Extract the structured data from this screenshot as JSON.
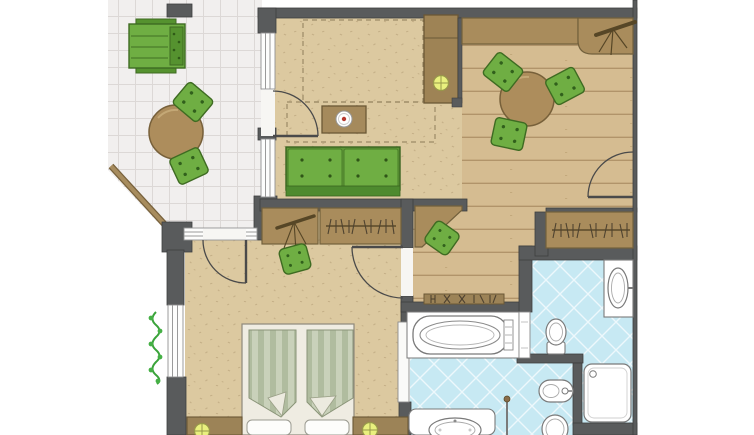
{
  "scene": {
    "type": "floor-plan",
    "name": "apartment-floor-plan"
  },
  "colors": {
    "wall": "#595b5c",
    "room_floor": "#dcc9a0",
    "wood_floor": "#d5bc91",
    "terrace_tile": "#f1efee",
    "bath_tile": "#c7e9f3",
    "furniture_green": "#6fae43",
    "furniture_wood": "#a28a5b",
    "fixture_white": "#ffffff",
    "lamp_yellow": "#e9f07e",
    "plant_green": "#3aa33a"
  },
  "rooms": {
    "terrace": {
      "name": "terrace",
      "furniture": [
        "sun-lounger",
        "bistro-table",
        "chair",
        "chair"
      ]
    },
    "living_room": {
      "name": "living-room",
      "furniture": [
        "sofa",
        "coffee-table",
        "sideboard",
        "table-lamp",
        "fold-out-bed-outline"
      ]
    },
    "dining_room": {
      "name": "dining-room",
      "furniture": [
        "dining-table",
        "chair",
        "chair",
        "chair",
        "tv-counter",
        "wardrobe"
      ]
    },
    "hallway": {
      "name": "hallway",
      "furniture": [
        "desk",
        "stool",
        "luggage-rack"
      ]
    },
    "bedroom": {
      "name": "bedroom",
      "furniture": [
        "double-bed",
        "nightstand",
        "nightstand",
        "bedside-lamp",
        "bedside-lamp",
        "dressing-table",
        "stool",
        "wardrobe",
        "window-plant"
      ]
    },
    "bathroom": {
      "name": "bathroom",
      "fixtures": [
        "bathtub",
        "washbasin",
        "toilet",
        "bidet",
        "toilet",
        "double-washbasin",
        "shower"
      ]
    }
  }
}
